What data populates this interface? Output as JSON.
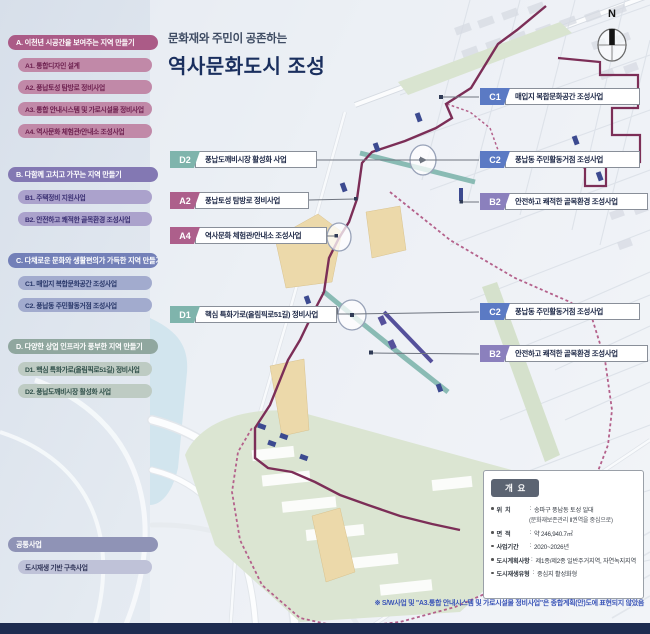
{
  "title": {
    "subtitle": "문화재와 주민이 공존하는",
    "main": "역사문화도시 조성"
  },
  "compass": {
    "north_label": "N"
  },
  "sidebar": {
    "sections": [
      {
        "header": "A. 이천년 시공간을 보여주는 지역 만들기",
        "items": [
          "A1. 통합디자인 설계",
          "A2. 풍납토성 탐방로 정비사업",
          "A3. 통합 안내시스템 및 가로시설물 정비사업",
          "A4. 역사문화 체험관/안내소 조성사업"
        ]
      },
      {
        "header": "B. 다함께 고치고 가꾸는 지역 만들기",
        "items": [
          "B1. 주택정비 지원사업",
          "B2. 안전하고 쾌적한 골목환경 조성사업"
        ]
      },
      {
        "header": "C. 다채로운 문화와 생활편의가 가득한 지역 만들기",
        "items": [
          "C1. 매입지 복합문화공간 조성사업",
          "C2. 풍납동 주민활동거점 조성사업"
        ]
      },
      {
        "header": "D. 다양한 상업 인프라가 풍부한 지역 만들기",
        "items": [
          "D1. 핵심 특화가로(올림픽로51길) 정비사업",
          "D2. 풍납도깨비시장 활성화 사업"
        ]
      }
    ],
    "common": {
      "header": "공통사업",
      "items": [
        "도시재생 기반 구축사업"
      ]
    }
  },
  "callouts": {
    "c1": {
      "code": "C1",
      "label": "매입지 복합문화공간 조성사업"
    },
    "c2": {
      "code": "C2",
      "label": "풍납동 주민활동거점 조성사업"
    },
    "b2": {
      "code": "B2",
      "label": "안전하고 쾌적한 골목환경 조성사업"
    },
    "d2": {
      "code": "D2",
      "label": "풍납도깨비시장 활성화 사업"
    },
    "a2": {
      "code": "A2",
      "label": "풍납토성 탐방로 정비사업"
    },
    "a4": {
      "code": "A4",
      "label": "역사문화 체험관/안내소 조성사업"
    },
    "d1": {
      "code": "D1",
      "label": "핵심 특화가로(올림픽로51길) 정비사업"
    }
  },
  "overview": {
    "title": "개  요",
    "sep": ":",
    "rows": [
      {
        "label": "위  치",
        "value": "송파구 풍납동 토성 일대",
        "note": "(문화재보존관리 Ⅱ권역을 중심으로)"
      },
      {
        "label": "면  적",
        "value": "약 246,940.7㎡"
      },
      {
        "label": "사업기간",
        "value": "2020~2026년"
      },
      {
        "label": "도시계획사항",
        "value": "제1종/제2종 일반주거지역, 자연녹지지역"
      },
      {
        "label": "도시재생유형",
        "value": "중심지 활성화형"
      }
    ]
  },
  "footnote": "※ S/W사업 및 \"A3.통합 안내시스템 및 가로시설물 정비사업\"은 종합계획(안)도에 표현되지 않았음",
  "colors": {
    "section_a": "#ab5b87",
    "section_b": "#8378b3",
    "section_c": "#7380b8",
    "section_d": "#90a79f",
    "common": "#8f93b6",
    "badge_a": "#ad5f8b",
    "badge_b": "#8b80bd",
    "badge_c": "#5b7ac4",
    "badge_d": "#7fb4ac",
    "fortress_wall_line": "#7c2e57",
    "project_boundary_dashed": "#b4618b",
    "market_street_teal": "#84b7b0",
    "core_street_purple": "#55509b",
    "title_navy": "#1a2f5e",
    "bottom_bar": "#1e2c50"
  }
}
